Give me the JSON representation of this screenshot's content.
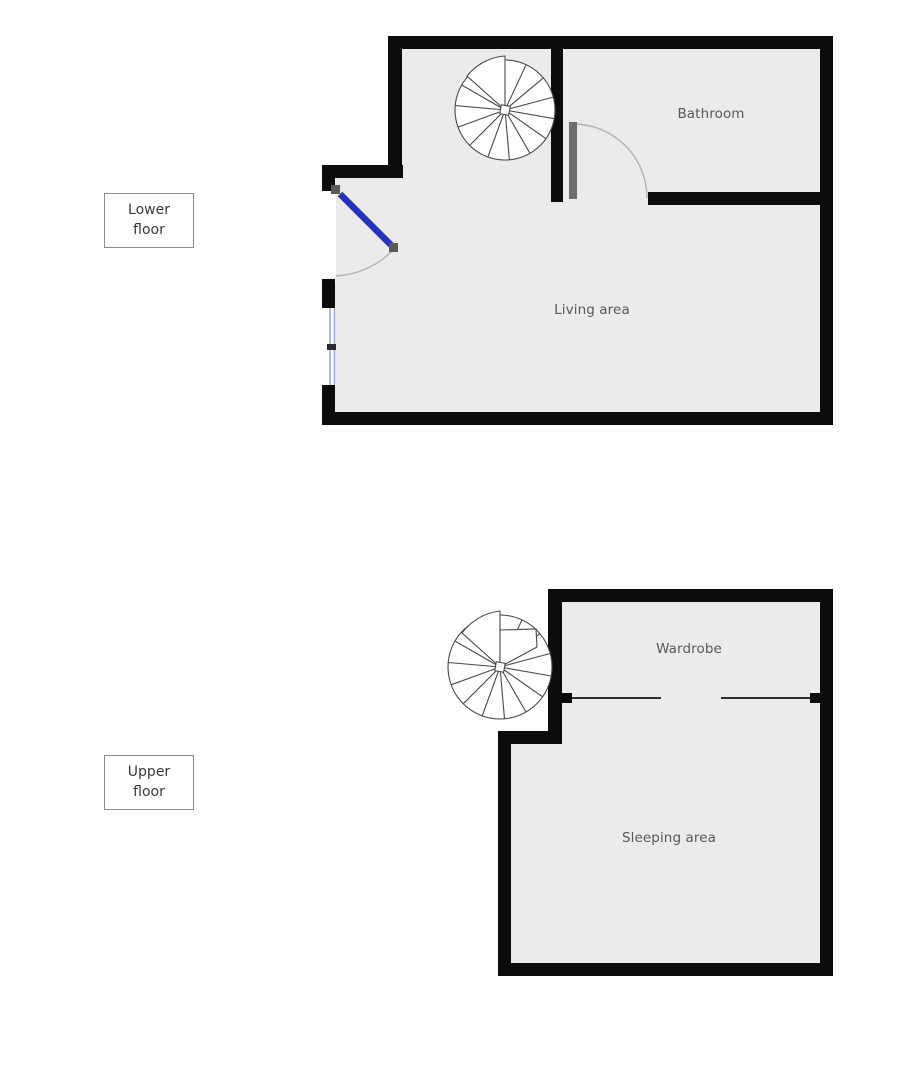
{
  "legend": {
    "lower": {
      "line1": "Lower",
      "line2": "floor"
    },
    "upper": {
      "line1": "Upper",
      "line2": "floor"
    }
  },
  "rooms": {
    "bathroom": "Bathroom",
    "living_area": "Living area",
    "wardrobe": "Wardrobe",
    "sleeping_area": "Sleeping area"
  },
  "icons": {
    "staircase": "spiral-staircase"
  },
  "colors": {
    "background": "#FFFFFF",
    "wall": "#0C0C0C",
    "floor_fill": "#ECEBE9",
    "door_leaf": "#2434BF",
    "door_hinge": "#5A5A5A",
    "bathroom_door": "#6E6E6E",
    "window_frame": "#9BA3D8",
    "window_tick": "#2B2B2B",
    "swing_arc": "#B3B3B3",
    "stair_stroke": "#4A4A4A",
    "divider": "#2F2F2F",
    "room_text": "#58585A",
    "legend_text": "#3A3A3A",
    "legend_border": "#8A8A8A"
  }
}
